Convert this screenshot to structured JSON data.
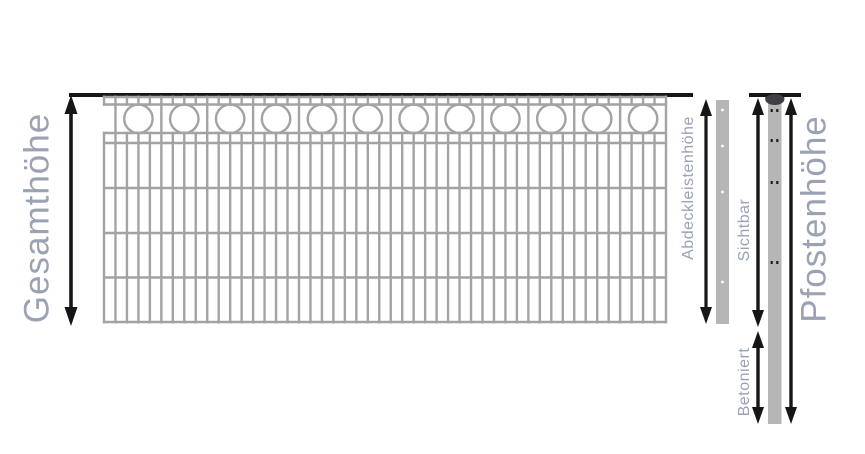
{
  "diagram": {
    "labels": {
      "gesamthoehe": "Gesamthöhe",
      "abdeckleistenhoehe": "Abdeckleistenhöhe",
      "sichtbar": "Sichtbar",
      "betoniert": "Betoniert",
      "pfostenhoehe": "Pfostenhöhe"
    },
    "colors": {
      "background": "#ffffff",
      "label_text": "#9aa2b3",
      "measurement_black": "#161616",
      "fence_wire": "#a3a3a3",
      "metal_gray": "#b6b6b6",
      "post_cap": "#3f3f46",
      "hole_dark": "#1f1f1f",
      "hole_light": "#ffffff"
    },
    "fence": {
      "ring_count": 12,
      "vertical_bar_count": 50,
      "strip_hole_count": 4,
      "post_hole_pair_count": 4
    }
  }
}
